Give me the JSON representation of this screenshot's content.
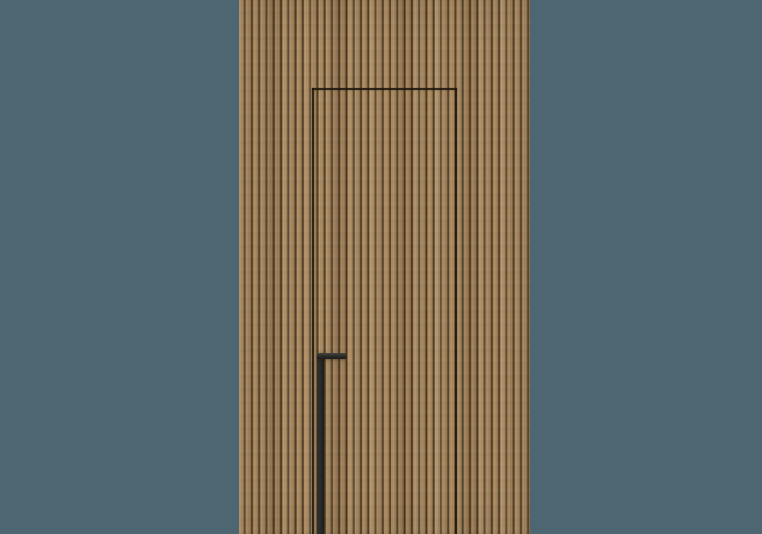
{
  "scene": {
    "type": "product-render",
    "subject": "Concealed flush door with a long dark recessed pull handle, set flush within a vertical wood slat wall panel on a plain slate backdrop",
    "background_color": "#4d6671",
    "wood": {
      "slat_light": "#b39066",
      "slat_mid": "#a8865c",
      "slat_shade": "#9c7c54",
      "groove": "#46371f",
      "groove_edge": "#6e573a",
      "slat_pitch_px": 7.27
    },
    "door": {
      "outline_color": "#1f170c"
    },
    "handle": {
      "body_color": "#2d2d2b",
      "dark_color": "#1d1d1c",
      "highlight_color": "#474741"
    }
  }
}
